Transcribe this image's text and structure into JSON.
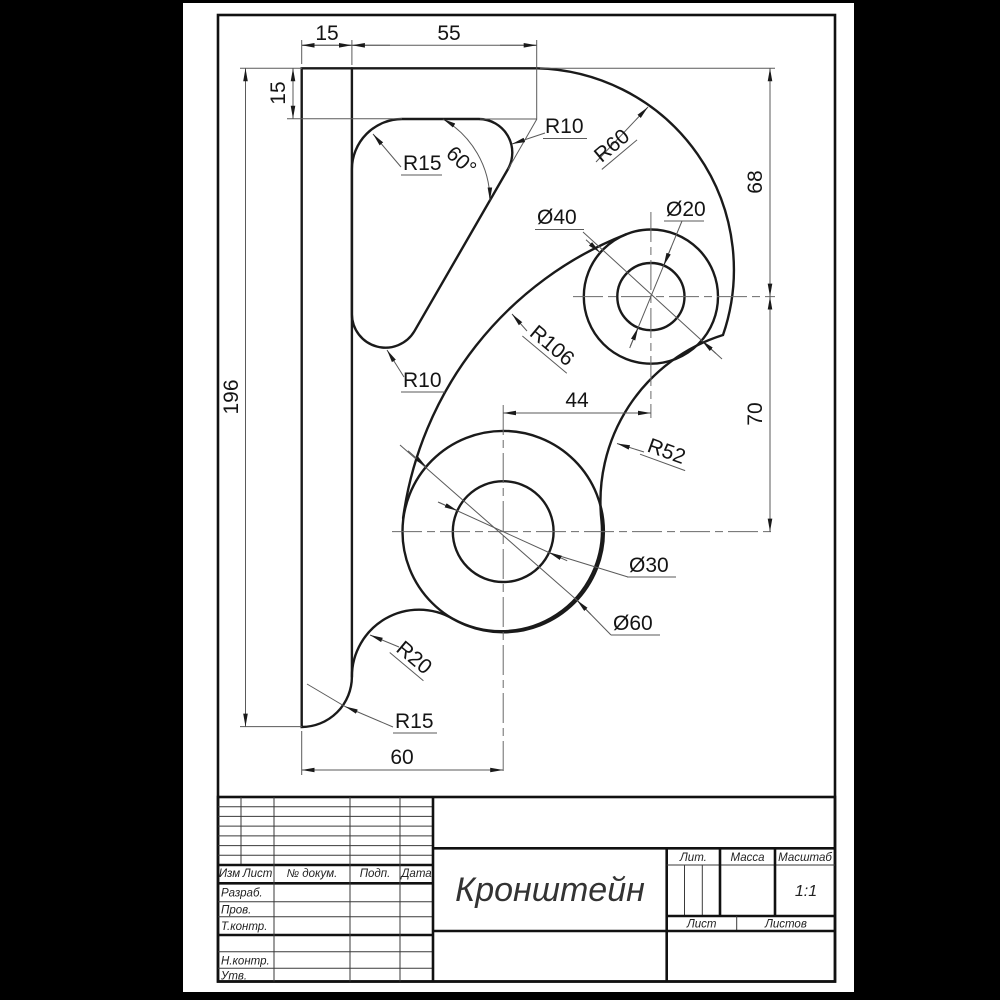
{
  "drawing": {
    "part_name": "Кронштейн",
    "dims": {
      "w15": "15",
      "w55": "55",
      "h15": "15",
      "h196": "196",
      "h68": "68",
      "h70": "70",
      "w44": "44",
      "w60": "60",
      "angle60": "60°"
    },
    "radii": {
      "r15_top": "R15",
      "r10_top": "R10",
      "r60": "R60",
      "r106": "R106",
      "r52": "R52",
      "r10_bottom": "R10",
      "r20": "R20",
      "r15_bottom": "R15"
    },
    "diameters": {
      "d40": "Ø40",
      "d20": "Ø20",
      "d30": "Ø30",
      "d60": "Ø60"
    }
  },
  "title_block": {
    "title": "Кронштейн",
    "scale_value": "1:1",
    "lit": "Лит.",
    "massa": "Масса",
    "masshtab": "Масштаб",
    "list": "Лист",
    "listov": "Листов",
    "col_izm": "Изм",
    "col_list": "Лист",
    "col_ndokum": "№ докум.",
    "col_podp": "Подп.",
    "col_data": "Дата",
    "row_razrab": "Разраб.",
    "row_prov": "Пров.",
    "row_tkontr": "Т.контр.",
    "row_nkontr": "Н.контр.",
    "row_utv": "Утв."
  },
  "colors": {
    "paper": "#ffffff",
    "ink": "#1a1a1a",
    "background": "#000000"
  }
}
